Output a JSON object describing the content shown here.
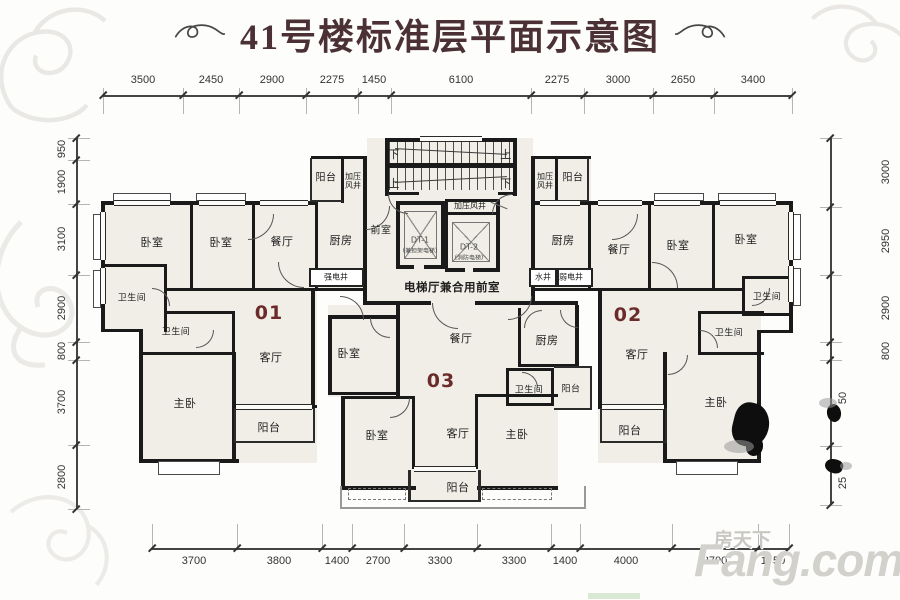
{
  "title": "41号楼标准层平面示意图",
  "units": {
    "u01": "01",
    "u02": "02",
    "u03": "03"
  },
  "labels": {
    "u01": {
      "bed1": "卧室",
      "bed2": "卧室",
      "dining": "餐厅",
      "kitchen": "厨房",
      "bath1": "卫生间",
      "bath2": "卫生间",
      "living": "客厅",
      "master": "主卧",
      "balcony": "阳台",
      "shaft": "强电井"
    },
    "core": {
      "balcony_l": "阳台",
      "press_l": "加压风井",
      "down_tl": "下",
      "up_tr": "上",
      "up_bl": "上",
      "down_br": "下",
      "front": "前室",
      "dt1": "DT-1",
      "dt1_note": "(兼担架电梯)",
      "dt2": "DT-2",
      "dt2_note": "(消防电梯)",
      "press_c": "加压风井",
      "hall": "电梯厅兼合用前室",
      "press_r": "加压风井",
      "balcony_r": "阳台",
      "water": "水井",
      "weak": "弱电井"
    },
    "u02": {
      "kitchen": "厨房",
      "dining": "餐厅",
      "bed1": "卧室",
      "bed2": "卧室",
      "bath1": "卫生间",
      "living": "客厅",
      "bath2": "卫生间",
      "master": "主卧",
      "balcony": "阳台"
    },
    "u03": {
      "bed1": "卧室",
      "dining": "餐厅",
      "kitchen": "厨房",
      "bath": "卫生间",
      "balcony_r": "阳台",
      "bed2": "卧室",
      "living": "客厅",
      "master": "主卧",
      "balcony": "阳台"
    }
  },
  "dimensions": {
    "top": [
      "3500",
      "2450",
      "2900",
      "2275",
      "1450",
      "6100",
      "2275",
      "3000",
      "2650",
      "3400"
    ],
    "bottom": [
      "3700",
      "3800",
      "1400",
      "2700",
      "3300",
      "3300",
      "1400",
      "4000",
      "3700",
      "1350"
    ],
    "left": [
      "950",
      "1900",
      "3100",
      "2900",
      "800",
      "3700",
      "2800"
    ],
    "right": [
      "3000",
      "2950",
      "2900",
      "800",
      "50",
      "25"
    ]
  },
  "watermark": {
    "cn": "房天下",
    "en": "Fang.com"
  },
  "colors": {
    "wall": "#1a1a1a",
    "room_fill": "#f0eee6",
    "unit_number": "#6b2b2b",
    "title": "#4b3136"
  }
}
